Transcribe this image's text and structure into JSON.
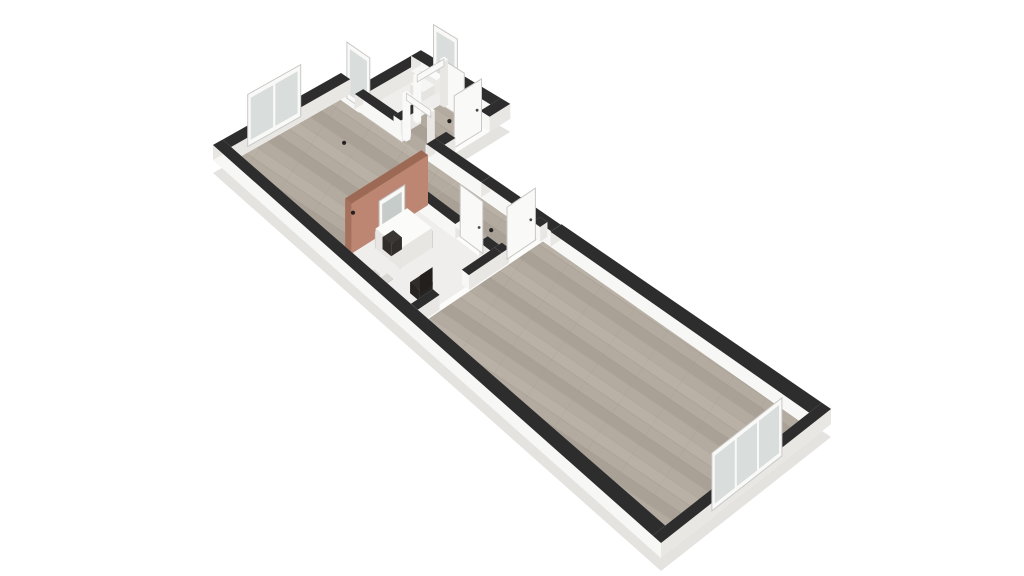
{
  "meta": {
    "type": "3d-isometric-floor-plan-render",
    "background": "#ffffff"
  },
  "colors": {
    "background": "#ffffff",
    "wall_top": "#2d2d2d",
    "wall_face_bright": "#f7f7f6",
    "wall_face_shade": "#e9e7e4",
    "slab_side": "#e5e3e0",
    "slab_top": "#fcfcfb",
    "floor_wood": "#b3aaa0",
    "floor_wood_dark": "#aaa196",
    "floor_wood_light": "#bab1a6",
    "floor_wood_seam": "#9e968b",
    "floor_white": "#efeeec",
    "accent_face": "#bc8673",
    "accent_side": "#a5705c",
    "accent_top": "#9c6a54",
    "glass": "#d9dedd",
    "panel_white": "#f9f9f8",
    "panel_edge": "#c9c8c6",
    "mirror_glass": "#c6ccca",
    "furniture_dark": "#312d2a",
    "furniture_mat": "#dbd9d5",
    "dot": "#242220"
  },
  "scene": {
    "projection": {
      "W": [
        213,
        160
      ],
      "N": [
        341,
        88
      ],
      "E": [
        831,
        424
      ],
      "S": [
        661,
        558
      ]
    },
    "wall_height": 15,
    "slab_footprint": [
      [
        0,
        0
      ],
      [
        4,
        0
      ],
      [
        4,
        0.6
      ],
      [
        5.9,
        0.6
      ],
      [
        5.9,
        3.4
      ],
      [
        4,
        3.4
      ],
      [
        4,
        16
      ],
      [
        0,
        16
      ]
    ],
    "floors": [
      {
        "id": "bedroom-floor",
        "kind": "wood",
        "a": [
          0.3,
          3.7
        ],
        "b": [
          0.3,
          4.15
        ]
      },
      {
        "id": "corridor-floor",
        "kind": "wood",
        "a": [
          2.72,
          3.7
        ],
        "b": [
          4.15,
          6.8
        ]
      },
      {
        "id": "hall-floor",
        "kind": "wood",
        "a": [
          3.7,
          5.6
        ],
        "b": [
          0.9,
          3.1
        ]
      },
      {
        "id": "wc-floor",
        "kind": "white",
        "a": [
          3.95,
          5.6
        ],
        "b": [
          0.9,
          1.94
        ]
      },
      {
        "id": "study-floor",
        "kind": "white",
        "a": [
          0.3,
          2.5
        ],
        "b": [
          4.15,
          6.8
        ]
      },
      {
        "id": "living-room-floor",
        "kind": "wood",
        "a": [
          0.3,
          3.7
        ],
        "b": [
          6.95,
          15.7
        ]
      }
    ],
    "walls": [
      {
        "id": "exterior-wall-nw",
        "axis": "A",
        "c": 0.15,
        "from": 0,
        "to": 4,
        "t": 0.3
      },
      {
        "id": "exterior-wall-sw",
        "axis": "B",
        "c": 0.15,
        "from": 0,
        "to": 16,
        "t": 0.3
      },
      {
        "id": "exterior-wall-se",
        "axis": "A",
        "c": 15.85,
        "from": 0,
        "to": 4,
        "t": 0.3
      },
      {
        "id": "exterior-wall-ne-a",
        "axis": "B",
        "c": 3.85,
        "from": 0,
        "to": 0.75,
        "t": 0.3
      },
      {
        "id": "bath-block-wall-nw",
        "axis": "A",
        "c": 0.75,
        "from": 3.7,
        "to": 5.9,
        "t": 0.3
      },
      {
        "id": "bath-block-wall-ne",
        "axis": "B",
        "c": 5.75,
        "from": 0.6,
        "to": 3.4,
        "t": 0.3
      },
      {
        "id": "bath-block-wall-se-1",
        "axis": "A",
        "c": 3.25,
        "from": 3.7,
        "to": 4.3,
        "t": 0.3
      },
      {
        "id": "bath-block-wall-se-2",
        "axis": "A",
        "c": 3.25,
        "from": 5.3,
        "to": 5.9,
        "t": 0.3
      },
      {
        "id": "bedroom-ne-wall-1",
        "axis": "B",
        "c": 3.85,
        "from": 0.75,
        "to": 2.3,
        "t": 0.26
      },
      {
        "id": "bedroom-ne-wall-2",
        "axis": "B",
        "c": 3.85,
        "from": 3.1,
        "to": 4.9,
        "t": 0.26
      },
      {
        "id": "interior-ne-wall",
        "axis": "B",
        "c": 3.85,
        "from": 4.9,
        "to": 7.2,
        "t": 0.26
      },
      {
        "id": "exterior-wall-ne-b",
        "axis": "B",
        "c": 3.85,
        "from": 7.2,
        "to": 16,
        "t": 0.3
      },
      {
        "id": "wc-partition-1",
        "axis": "A",
        "c": 2.0,
        "from": 3.85,
        "to": 4.45,
        "t": 0.24
      },
      {
        "id": "wc-partition-2",
        "axis": "A",
        "c": 2.0,
        "from": 5.25,
        "to": 5.75,
        "t": 0.24
      },
      {
        "id": "accent-wall",
        "axis": "A",
        "c": 4.15,
        "from": 0.55,
        "to": 2.75,
        "t": 0.22,
        "h": 50,
        "accent": true
      },
      {
        "id": "study-corridor-wall-1",
        "axis": "B",
        "c": 2.6,
        "from": 4.15,
        "to": 5.5,
        "t": 0.24
      },
      {
        "id": "study-corridor-wall-2",
        "axis": "B",
        "c": 2.6,
        "from": 6.3,
        "to": 6.8,
        "t": 0.24
      },
      {
        "id": "study-se-wall-1",
        "axis": "A",
        "c": 6.8,
        "from": 0.3,
        "to": 0.9,
        "t": 0.24
      },
      {
        "id": "study-se-wall-2",
        "axis": "A",
        "c": 6.8,
        "from": 1.7,
        "to": 2.6,
        "t": 0.24
      },
      {
        "id": "living-nw-wall-1",
        "axis": "A",
        "c": 6.8,
        "from": 2.6,
        "to": 2.8,
        "t": 0.24
      },
      {
        "id": "living-nw-wall-2",
        "axis": "A",
        "c": 6.8,
        "from": 3.65,
        "to": 3.85,
        "t": 0.24
      }
    ],
    "panels": [
      {
        "id": "window-2pane",
        "axis": "A",
        "c": 0.15,
        "from": 0.95,
        "to": 2.6,
        "h": 52,
        "kind": "window",
        "panes": 2
      },
      {
        "id": "window-3pane",
        "axis": "A",
        "c": 15.85,
        "from": 1.3,
        "to": 2.95,
        "h": 58,
        "kind": "window",
        "panes": 3
      },
      {
        "id": "tall-glass-door-1",
        "axis": "B",
        "c": 3.85,
        "from": 0.35,
        "to": 1.1,
        "h": 56,
        "kind": "window",
        "panes": 1
      },
      {
        "id": "tall-glass-door-2",
        "axis": "B",
        "c": 5.75,
        "from": 1.15,
        "to": 1.9,
        "h": 54,
        "kind": "window",
        "panes": 1
      },
      {
        "id": "entry-door-leaf",
        "axis": "A",
        "c": 3.25,
        "from": 4.4,
        "to": 5.2,
        "h": 52,
        "kind": "door"
      },
      {
        "id": "study-door-leaf",
        "axis": "B",
        "c": 2.6,
        "from": 5.52,
        "to": 6.28,
        "h": 52,
        "kind": "door"
      },
      {
        "id": "living-door-leaf",
        "axis": "A",
        "c": 6.8,
        "from": 2.84,
        "to": 3.62,
        "h": 52,
        "kind": "door"
      },
      {
        "id": "wc-door-leaf",
        "axis": "B",
        "c": 5.22,
        "from": 2.05,
        "to": 2.68,
        "h": 46,
        "kind": "door"
      },
      {
        "id": "leaning-mirror",
        "axis": "A",
        "c": 4.38,
        "from": 1.25,
        "to": 1.98,
        "h": 40,
        "kind": "mirror"
      }
    ],
    "frames": [
      {
        "id": "bedroom-doorway-frame",
        "axis": "B",
        "c": 3.85,
        "from": 2.3,
        "to": 3.1,
        "h": 46
      },
      {
        "id": "wc-doorway-frame",
        "axis": "A",
        "c": 2.0,
        "from": 4.45,
        "to": 5.25,
        "h": 46
      }
    ],
    "furniture": [
      {
        "id": "dresser",
        "type": "box",
        "a": [
          1.95,
          2.45
        ],
        "b": [
          3.35,
          3.8
        ],
        "h": 15,
        "top": "#fafaf9",
        "face": "#e9e8e5"
      },
      {
        "id": "toilet-tank",
        "type": "box",
        "a": [
          5.38,
          5.58
        ],
        "b": [
          1.12,
          1.62
        ],
        "h": 15,
        "top": "#fbfbfa",
        "face": "#eceae7"
      },
      {
        "id": "toilet-bowl",
        "type": "box",
        "a": [
          5.02,
          5.38
        ],
        "b": [
          1.17,
          1.57
        ],
        "h": 9,
        "top": "#f6f6f4",
        "face": "#e6e4e1"
      },
      {
        "id": "desk",
        "type": "desk",
        "a": [
          1.05,
          1.95
        ],
        "b": [
          4.5,
          5.35
        ],
        "h": 20
      },
      {
        "id": "desk-pc",
        "type": "box",
        "a": [
          1.15,
          1.45
        ],
        "b": [
          4.62,
          4.92
        ],
        "h": 12,
        "top": "#3a3633",
        "face": "#312d2a"
      },
      {
        "id": "office-chair",
        "type": "chair",
        "a": [
          0.75,
          1.1
        ],
        "b": [
          6.08,
          6.42
        ],
        "h": 11
      },
      {
        "id": "floor-mat-1",
        "type": "box",
        "a": [
          0.42,
          0.6
        ],
        "b": [
          5.0,
          5.2
        ],
        "h": 1.5,
        "top": "#dbd9d5",
        "face": "#d2d0cc"
      },
      {
        "id": "floor-mat-2",
        "type": "box",
        "a": [
          0.55,
          0.73
        ],
        "b": [
          5.3,
          5.5
        ],
        "h": 1.5,
        "top": "#dbd9d5",
        "face": "#d2d0cc"
      }
    ],
    "light_dots": [
      [
        2.7,
        1.5
      ],
      [
        1.35,
        3.35
      ],
      [
        3.15,
        5.9
      ],
      [
        4.9,
        2.55
      ]
    ]
  }
}
